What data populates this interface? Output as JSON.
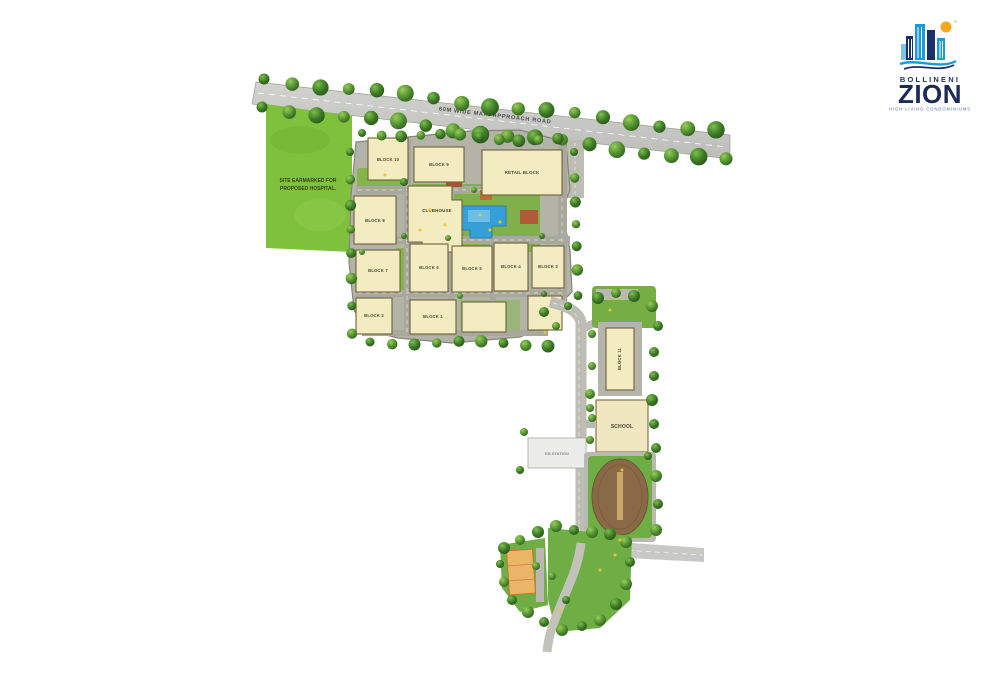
{
  "logo": {
    "brand": "BOLLINENI",
    "name": "ZION",
    "tagline": "HIGH LIVING CONDOMINIUMS"
  },
  "labels": {
    "road": "60M WIDE MAIN APPROACH ROAD",
    "hospital_line1": "SITE EARMARKED FOR",
    "hospital_line2": "PROPOSED HOSPITAL.",
    "retail": "RETAIL BLOCK",
    "clubhouse": "CLUBHOUSE",
    "school": "SCHOOL",
    "eb_station": "EB STATION"
  },
  "blocks": [
    {
      "label": "BLOCK 10"
    },
    {
      "label": "BLOCK 9"
    },
    {
      "label": "BLOCK 8"
    },
    {
      "label": "BLOCK 7"
    },
    {
      "label": "BLOCK 6"
    },
    {
      "label": "BLOCK 5"
    },
    {
      "label": "BLOCK 4"
    },
    {
      "label": "BLOCK 3"
    },
    {
      "label": "BLOCK 2"
    },
    {
      "label": "BLOCK 1"
    },
    {
      "label": "BLOCK 11"
    }
  ],
  "colors": {
    "site_green": "#7fc13c",
    "tree_green": "#3d7a26",
    "road_grey": "#c8c8c4",
    "building_beige": "#f2ecc0",
    "pool_blue": "#35a0d8",
    "logo_navy": "#1c2a56",
    "logo_blue": "#1a9bd7",
    "sun_orange": "#f6a71f"
  }
}
